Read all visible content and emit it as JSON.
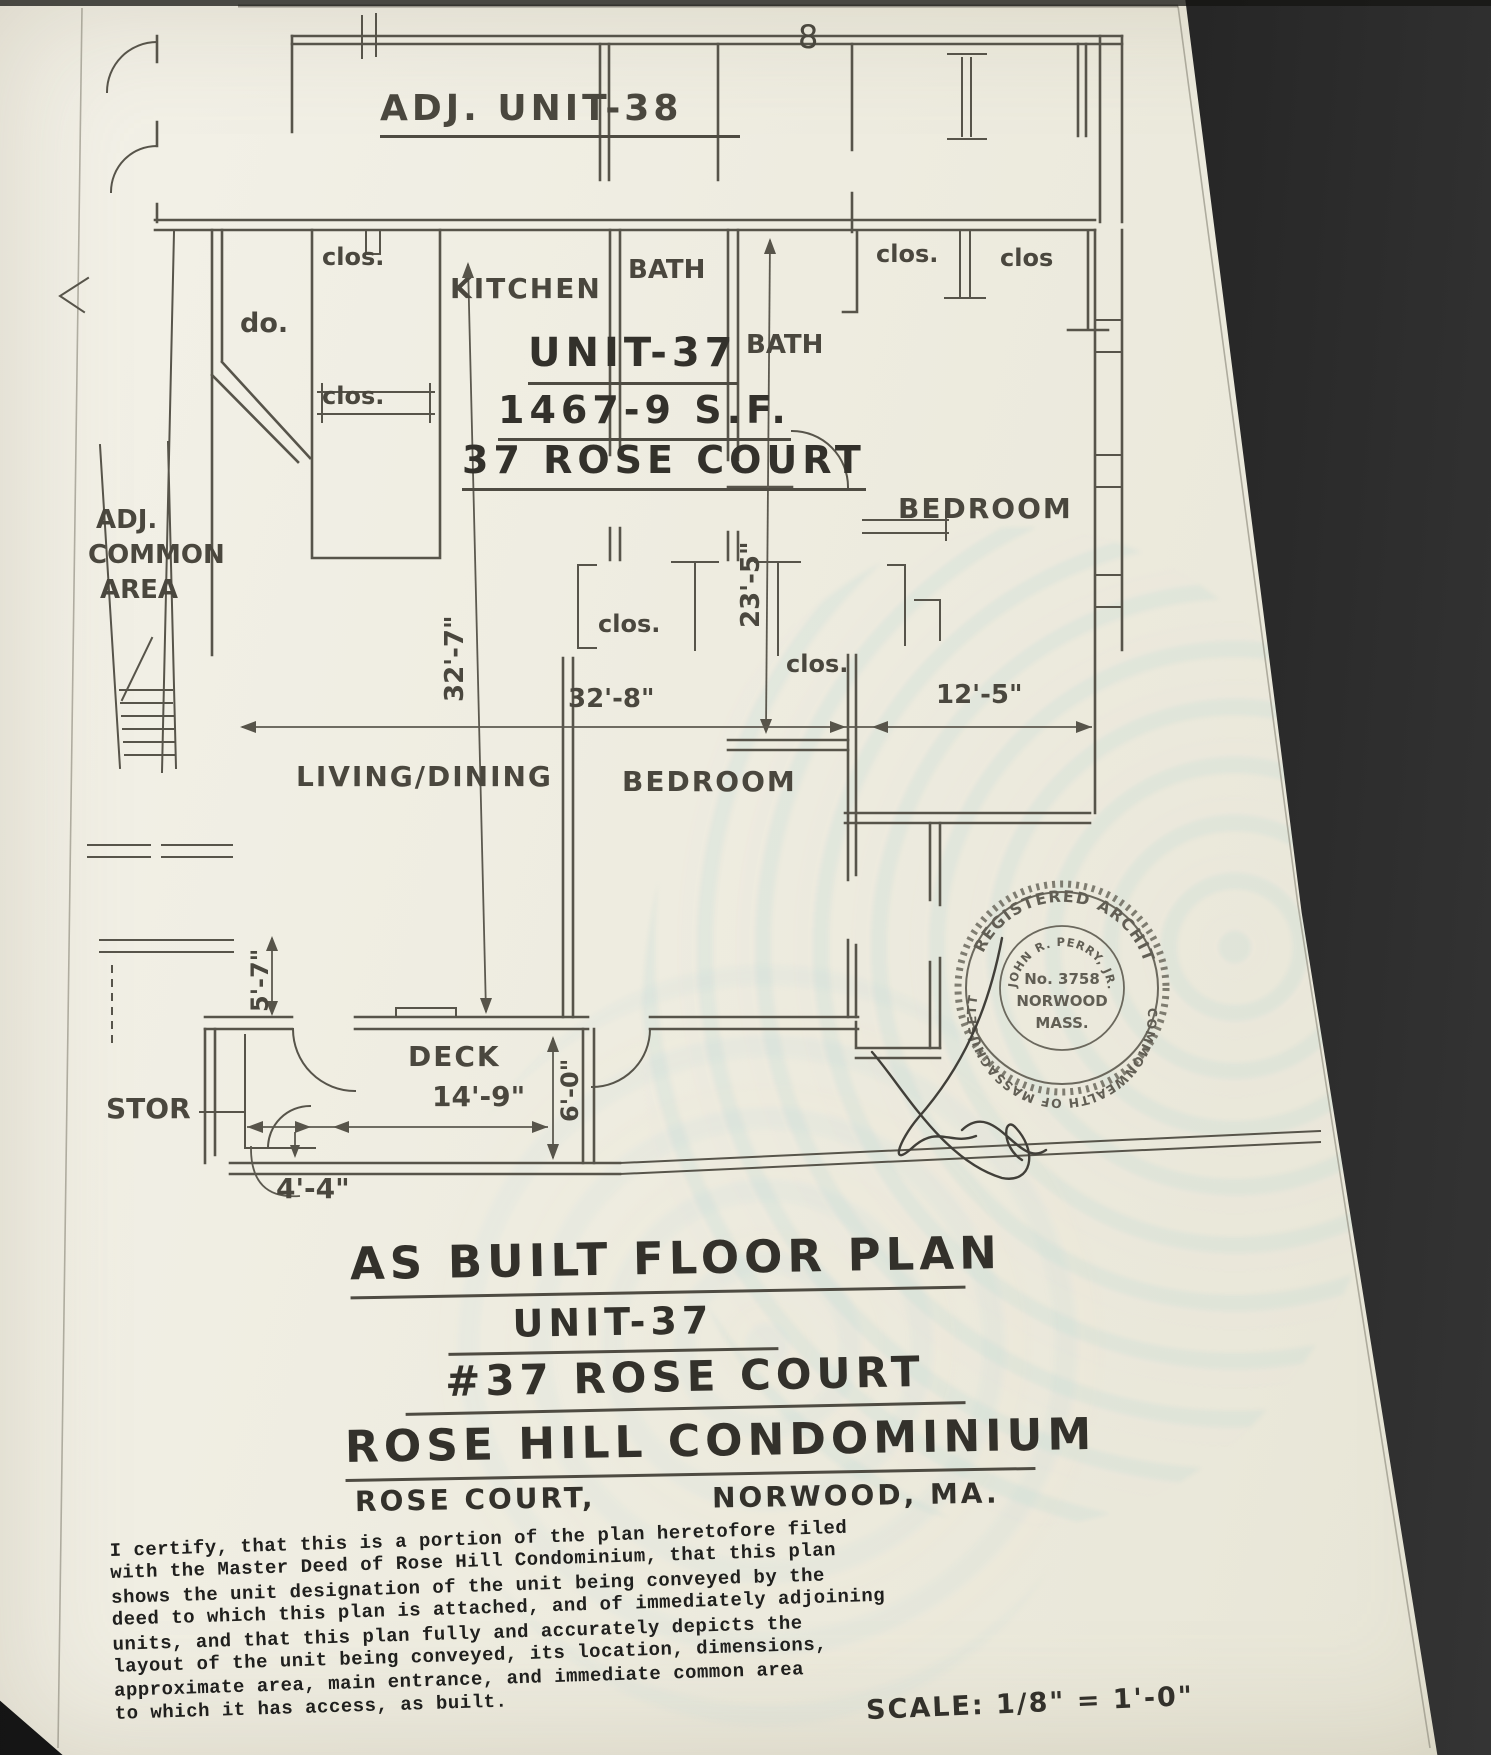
{
  "colors": {
    "paper": "#eeece0",
    "ink": "#57544a",
    "heavy_ink": "#33312b",
    "typewriter_ink": "#20201e",
    "screen_dark": "#1d1d1d",
    "seal_ink": "#615e54"
  },
  "plan": {
    "adjacent_unit_label": "ADJ. UNIT-38",
    "stray_mark": "8",
    "rooms": {
      "kitchen": "KITCHEN",
      "bath_upper": "BATH",
      "bath_inner": "BATH",
      "bedroom_right": "BEDROOM",
      "bedroom_lower": "BEDROOM",
      "living_dining": "LIVING/DINING",
      "deck": "DECK",
      "storage": "STOR"
    },
    "closets": {
      "clos1": "clos.",
      "ditto": "do.",
      "clos2": "clos.",
      "clos3": "clos.",
      "clos4": "clos",
      "clos5": "clos.",
      "clos6": "clos."
    },
    "unit_block": {
      "unit": "UNIT-37",
      "area": "1467-9 S.F.",
      "address": "37 ROSE COURT"
    },
    "common_area": {
      "line1": "ADJ.",
      "line2": "COMMON",
      "line3": "AREA"
    },
    "dimensions": {
      "d32_7": "32'-7\"",
      "d32_8": "32'-8\"",
      "d12_5": "12'-5\"",
      "d23_5": "23'-5\"",
      "d5_7": "5'-7\"",
      "d14_9": "14'-9\"",
      "d6_0": "6'-0\"",
      "d4_4": "4'-4\""
    }
  },
  "seal": {
    "top_arc": "REGISTERED ARCHITECT",
    "bottom_arc": "COMMONWEALTH OF MASSACHUSETTS",
    "inner_arc": "JOHN R. PERRY, JR.",
    "number": "No. 3758",
    "city": "NORWOOD",
    "state": "MASS."
  },
  "title_block": {
    "line1": "AS BUILT FLOOR PLAN",
    "line2": "UNIT-37",
    "line3": "#37 ROSE COURT",
    "line4": "ROSE HILL CONDOMINIUM",
    "line5_left": "ROSE COURT,",
    "line5_right": "NORWOOD, MA."
  },
  "certification": {
    "lines": [
      "I certify, that this is a portion of the plan heretofore filed",
      "with the Master Deed of Rose Hill Condominium, that this plan",
      "shows the unit designation of the unit being conveyed by the",
      "deed to which this plan is attached, and of immediately adjoining",
      "units, and that this plan fully and accurately depicts the",
      "layout of the unit being conveyed, its location, dimensions,",
      "approximate area, main entrance, and immediate common area",
      "to which it has access, as built."
    ]
  },
  "scale_note": "SCALE: 1/8\" = 1'-0\""
}
